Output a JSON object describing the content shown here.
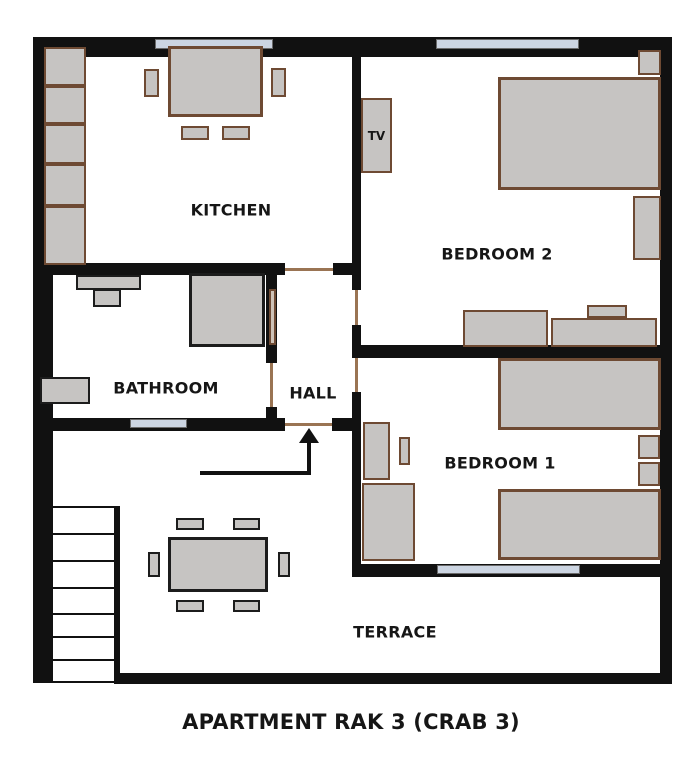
{
  "title": "APARTMENT RAK 3 (CRAB 3)",
  "rooms": {
    "kitchen": {
      "label": "KITCHEN"
    },
    "bathroom": {
      "label": "BATHROOM"
    },
    "hall": {
      "label": "HALL"
    },
    "bedroom2": {
      "label": "BEDROOM 2"
    },
    "bedroom1": {
      "label": "BEDROOM 1"
    },
    "terrace": {
      "label": "TERRACE"
    }
  },
  "appliances": {
    "tv_label": "TV"
  },
  "colors": {
    "wall": "#111111",
    "furniture-fill": "#c6c4c2",
    "furniture-brown": "#6e4a33",
    "furniture-dark": "#1c1c1c",
    "window-fill": "#ccd5e2",
    "window-border": "#6a6a6a",
    "door-line": "#9a7453",
    "text": "#161616",
    "background": "#ffffff"
  }
}
